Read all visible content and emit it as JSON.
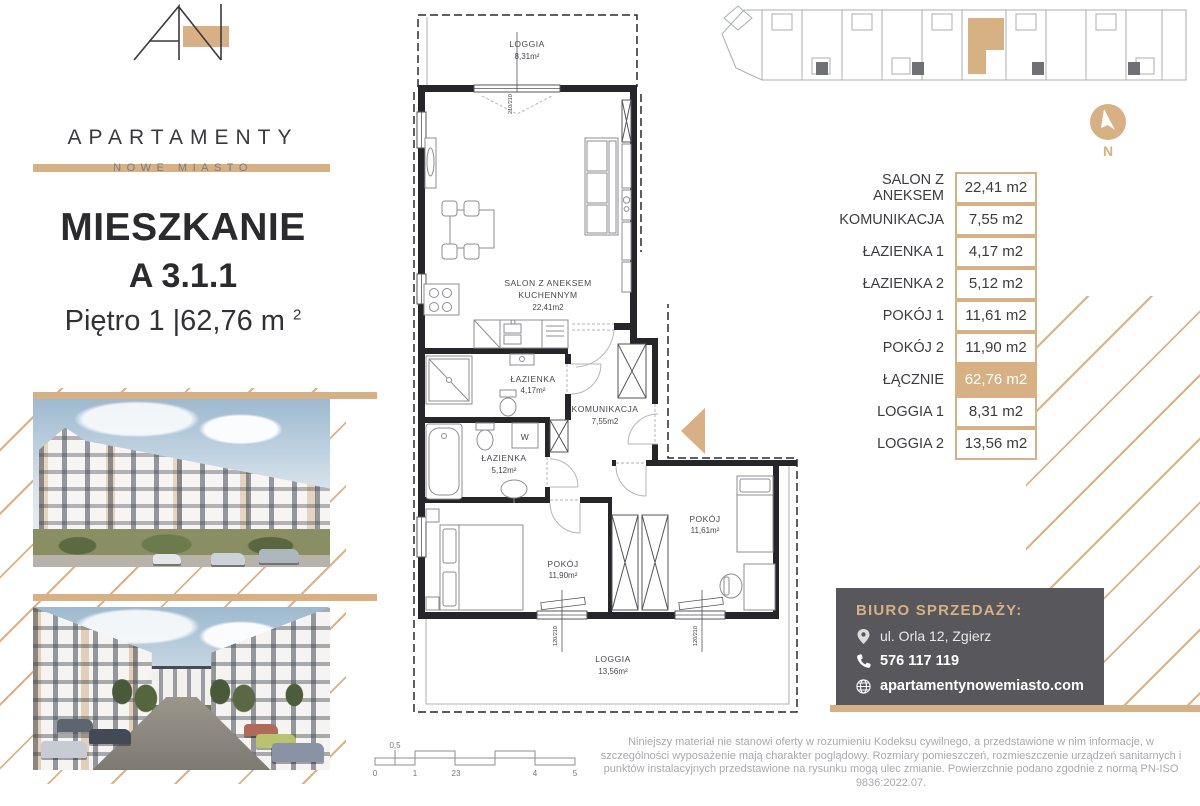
{
  "brand": {
    "name": "APARTAMENTY",
    "subtitle": "NOWE MIASTO"
  },
  "title": {
    "heading": "MIESZKANIE",
    "unit": "A 3.1.1",
    "floor": "Piętro 1",
    "sep": " |",
    "area": "62,76 m",
    "area_sup": "2"
  },
  "plan": {
    "loggia1": {
      "name": "LOGGIA",
      "area": "8,31m²"
    },
    "salon": {
      "line1": "SALON Z ANEKSEM",
      "line2": "KUCHENNYM",
      "area": "22,41m2"
    },
    "lazienka1": {
      "name": "ŁAZIENKA",
      "area": "4,17m²"
    },
    "lazienka2": {
      "name": "ŁAZIENKA",
      "area": "5,12m²"
    },
    "komunikacja": {
      "name": "KOMUNIKACJA",
      "area": "7,55m2"
    },
    "pokoj1": {
      "name": "POKÓJ",
      "area": "11,61m²"
    },
    "pokoj2": {
      "name": "POKÓJ",
      "area": "11,90m²"
    },
    "loggia2": {
      "name": "LOGGIA",
      "area": "13,56m²"
    },
    "closet": "W",
    "win_top": "210/210",
    "win_bottom": "120/210"
  },
  "area_table": {
    "rows": [
      {
        "label": "SALON Z ANEKSEM",
        "value": "22,41 m2"
      },
      {
        "label": "KOMUNIKACJA",
        "value": "7,55 m2"
      },
      {
        "label": "ŁAZIENKA 1",
        "value": "4,17 m2"
      },
      {
        "label": "ŁAZIENKA 2",
        "value": "5,12 m2"
      },
      {
        "label": "POKÓJ 1",
        "value": "11,61 m2"
      },
      {
        "label": "POKÓJ 2",
        "value": "11,90 m2"
      },
      {
        "label": "ŁĄCZNIE",
        "value": "62,76 m2"
      },
      {
        "label": "LOGGIA 1",
        "value": "8,31 m2"
      },
      {
        "label": "LOGGIA 2",
        "value": "13,56 m2"
      }
    ]
  },
  "compass": {
    "label": "N"
  },
  "contact": {
    "heading": "BIURO SPRZEDAŻY:",
    "address": "ul. Orla 12, Zgierz",
    "phone": "576 117 119",
    "website": "apartamentynowemiasto.com"
  },
  "scale_bar": {
    "half_label": "0,5",
    "labels": [
      "0",
      "1",
      "23",
      "4",
      "5"
    ]
  },
  "disclaimer": {
    "text": "Niniejszy materiał nie stanowi oferty w rozumieniu Kodeksu cywilnego, a przedstawione w nim informacje, w szczególności wyposażenie mają charakter poglądowy. Rozmiary pomieszczeń, rozmieszczenie urządzeń sanitarnych i punktów instalacyjnych przedstawione na rysunku mogą ulec zmianie. Powierzchnie podano zgodnie z normą PN-ISO 9836:2022.07."
  },
  "colors": {
    "accent": "#d7b083",
    "card": "#58585c"
  }
}
